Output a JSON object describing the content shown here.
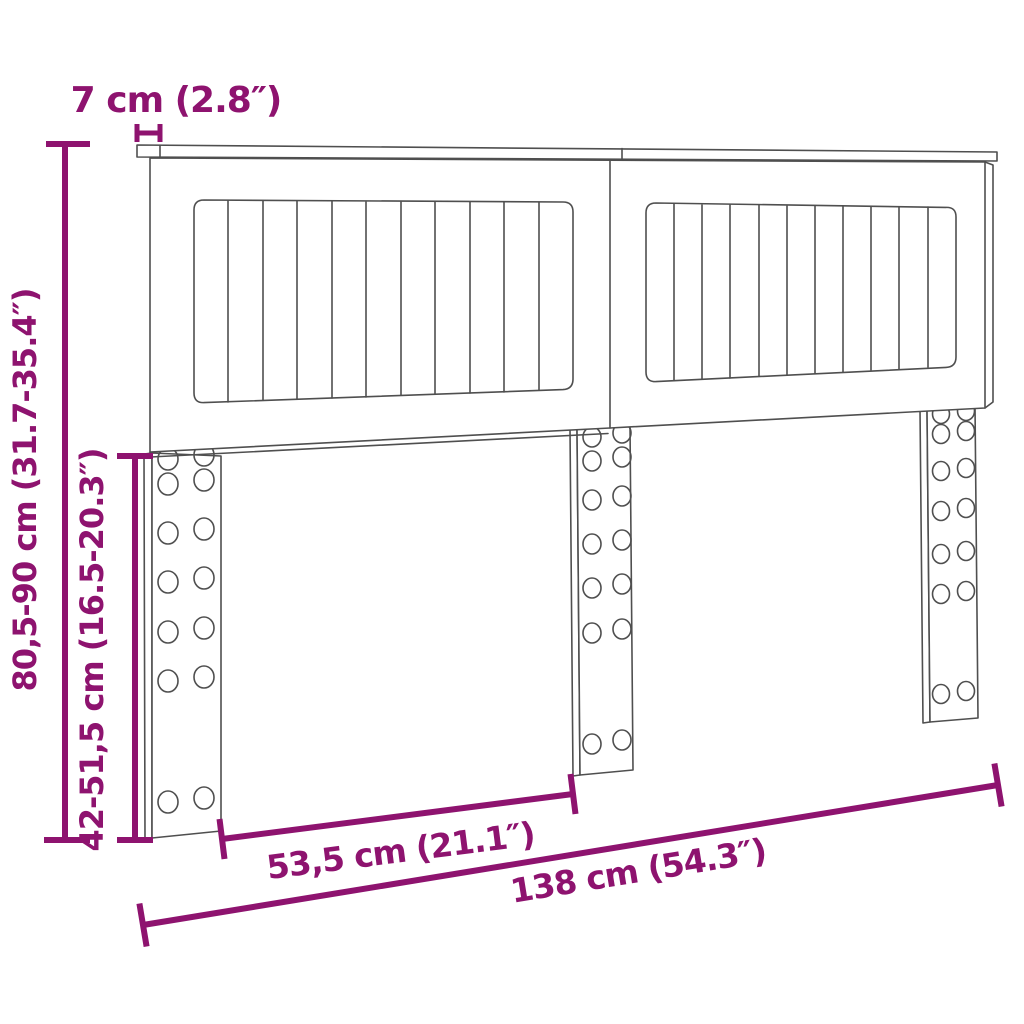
{
  "diagram": {
    "title": "headboard-dimension-diagram",
    "colors": {
      "accent": "#8E136F",
      "line": "#4F4F4F",
      "background": "#FFFFFF"
    },
    "labels": {
      "cap_width": "7 cm (2.8″)",
      "total_height": "80,5-90 cm (31.7-35.4″)",
      "leg_height": "42-51,5 cm (16.5-20.3″)",
      "half_width": "53,5 cm (21.1″)",
      "total_width": "138 cm (54.3″)"
    }
  }
}
